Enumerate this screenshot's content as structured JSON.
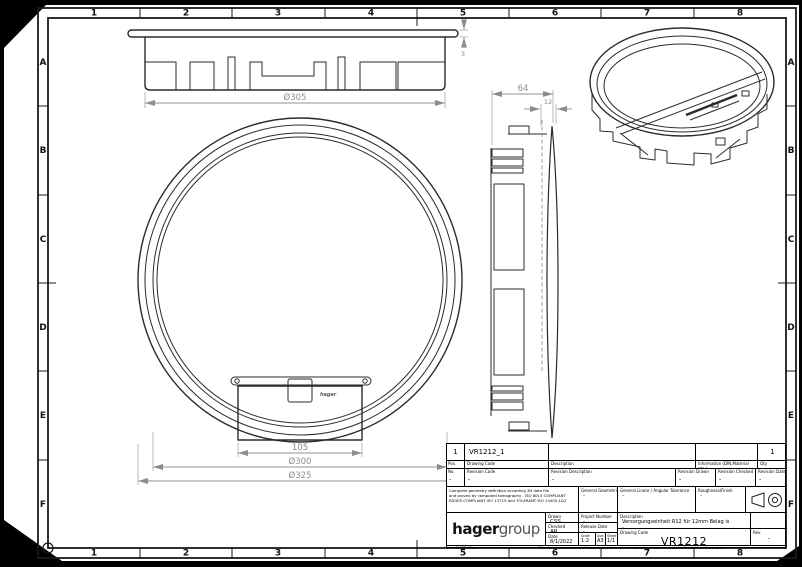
{
  "sheet": {
    "grid_cols": [
      "1",
      "2",
      "3",
      "4",
      "5",
      "6",
      "7",
      "8"
    ],
    "grid_rows": [
      "A",
      "B",
      "C",
      "D",
      "E",
      "F"
    ]
  },
  "views": {
    "front": {
      "dia": "Ø305",
      "flange_thickness": "3"
    },
    "plan": {
      "hatch_width": "105",
      "inner_dia": "Ø300",
      "outer_dia": "Ø325",
      "logo": "hager"
    },
    "side": {
      "depth": "64",
      "recess": "12"
    }
  },
  "title_block": {
    "parts": {
      "pos": "1",
      "drawing_code": "VR1212_1",
      "description": "",
      "information": "",
      "qty": "1"
    },
    "part_headers": {
      "pos": "Pos.",
      "drawing_code": "Drawing Code",
      "description": "Description",
      "information": "Information (DIN,Material etc.)",
      "qty": "Qty"
    },
    "revision_headers": {
      "no": "No.",
      "code": "Revision Code",
      "description": "Revision Description",
      "drawn": "Revision Drawn",
      "checked": "Revision Checked",
      "date": "Revision Date"
    },
    "revision_values": {
      "no": "-",
      "code": "-",
      "description": "-",
      "drawn": "-",
      "checked": "-",
      "date": "-"
    },
    "notes": {
      "line1": "Complete geometry definition according 3D data file",
      "line2": "and proved by computed tomography - ISO 8015 COMPLIANT",
      "line3": "EDGES COMPLIANT ISO 13715 and TOLERANT ISO 14405-1&2"
    },
    "tolerances": {
      "geometric_label": "General Geometric Tolerance",
      "geometric_value": "-",
      "linear_label": "General Linear / Angular Tolerance",
      "linear_value": "-",
      "roughness_label": "Roughness/Finish",
      "roughness_value": "-"
    },
    "logo": {
      "part1": "hager",
      "part2": "group"
    },
    "fields": {
      "drawn_label": "Drawn",
      "drawn": "CSS",
      "checked_label": "Checked",
      "checked": "AR",
      "date_label": "Date",
      "date": "8/1/2022",
      "project_label": "Project Number",
      "project": "-",
      "release_label": "Release Date",
      "release": "-",
      "scale_label": "Scale",
      "scale": "1:2",
      "size_label": "Size",
      "size": "A3",
      "sheet_label": "Sheet",
      "sheet": "1/1",
      "description_label": "Description",
      "description": "Versorgungseinheit R12 für 12mm Belag is",
      "description_line2": "-",
      "drawing_code_label": "Drawing Code",
      "drawing_code": "VR1212",
      "rev_label": "Rev.",
      "rev": "-"
    },
    "footer": {
      "form_ref": "A0007.03.a",
      "property_note": "This drawing is property of hager group, it is not reproduced and communicated without its authorization"
    }
  }
}
